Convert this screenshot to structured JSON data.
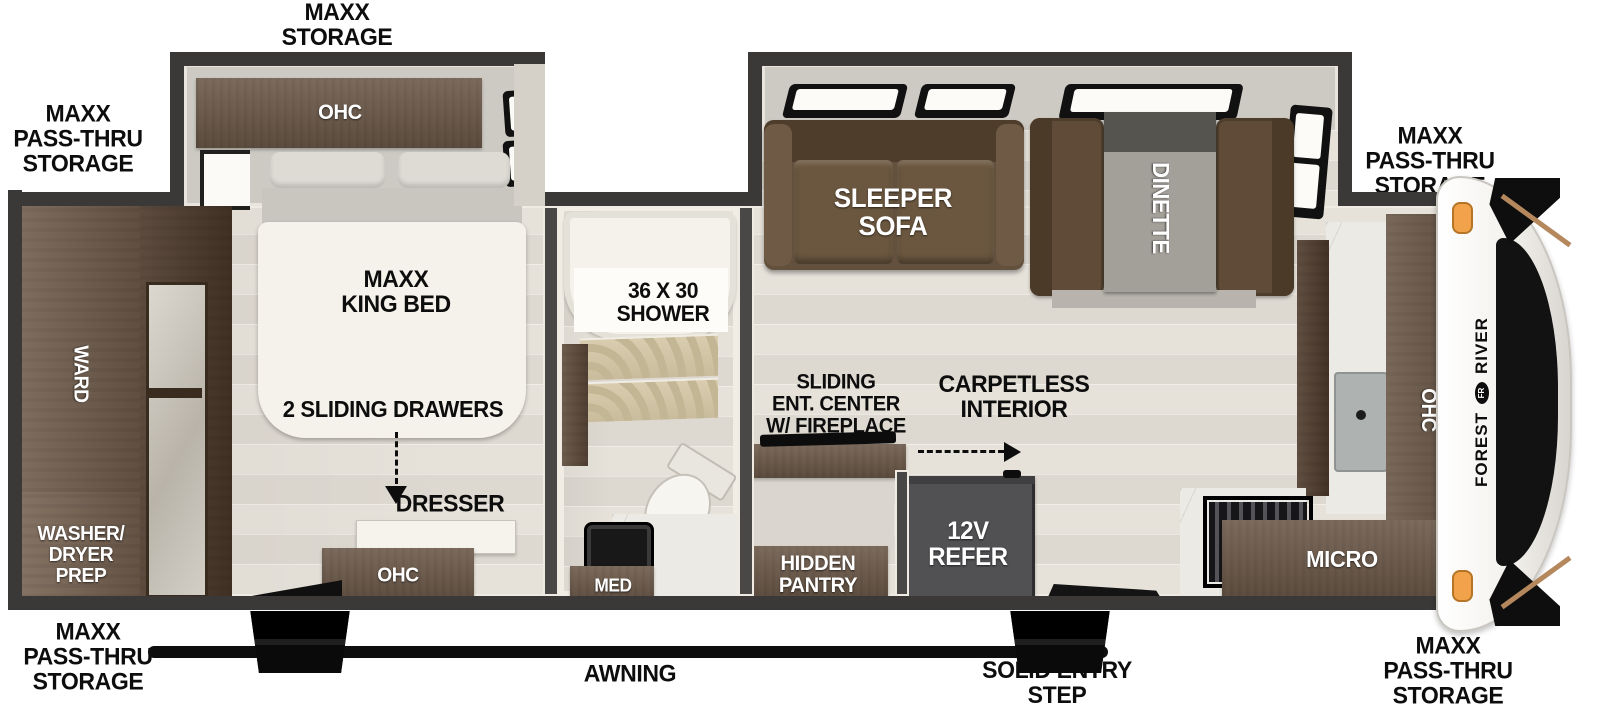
{
  "labels": {
    "storage_top": "MAXX\nSTORAGE",
    "passthru_left": "MAXX\nPASS-THRU\nSTORAGE",
    "passthru_top_right": "MAXX\nPASS-THRU\nSTORAGE",
    "passthru_bottom_left": "MAXX\nPASS-THRU\nSTORAGE",
    "passthru_bottom_right": "MAXX\nPASS-THRU\nSTORAGE",
    "awning": "AWNING",
    "solid_entry_step": "SOLID ENTRY\nSTEP"
  },
  "bedroom": {
    "ohc_slide": "OHC",
    "king_bed": "MAXX\nKING BED",
    "sliding_drawers": "2 SLIDING DRAWERS",
    "dresser": "DRESSER",
    "ohc_bottom": "OHC",
    "ward": "WARD",
    "washer_dryer": "WASHER/\nDRYER\nPREP"
  },
  "bathroom": {
    "shower": "36 X 30\nSHOWER",
    "med": "MED"
  },
  "living": {
    "sleeper_sofa": "SLEEPER\nSOFA",
    "dinette": "DINETTE",
    "ent_center": "SLIDING\nENT. CENTER\nW/ FIREPLACE",
    "carpetless": "CARPETLESS\nINTERIOR",
    "hidden_pantry": "HIDDEN\nPANTRY",
    "refer": "12V\nREFER"
  },
  "kitchen": {
    "micro": "MICRO",
    "ohc": "OHC"
  },
  "front_cap": {
    "brand_first": "FOREST",
    "brand_second": "RIVER",
    "badge": "FR"
  },
  "colors": {
    "wall": "#3b3937",
    "cabinet_brown": "#6d5a4a",
    "cabinet_dark": "#4c3a2b",
    "floor_wood": "#e2ded7",
    "bed_white": "#f4f2ea",
    "sofa_brown": "#63503d",
    "refer_gray": "#515154",
    "awning_black": "#0e0e0e",
    "marker_orange": "#f2a24a",
    "label_black": "#0d0d0d"
  }
}
